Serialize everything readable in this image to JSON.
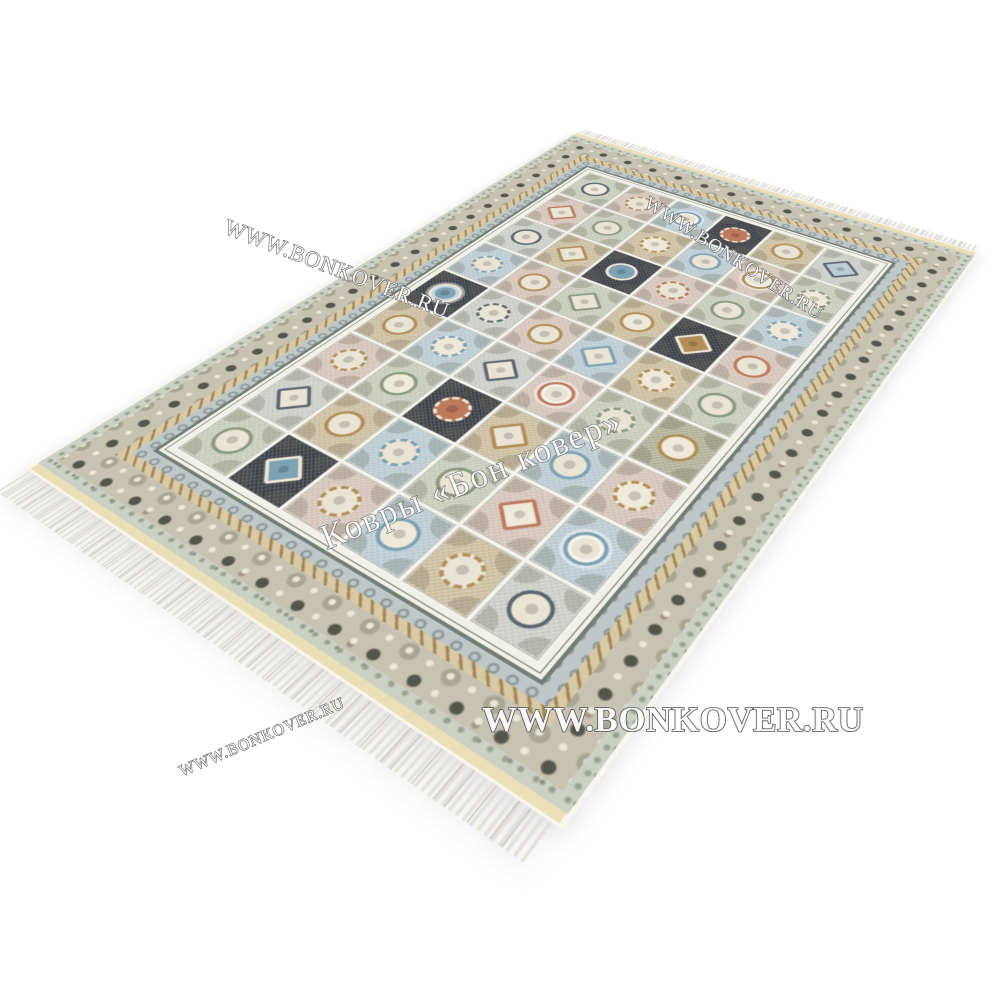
{
  "image": {
    "type": "product-photo",
    "subject": "perspective view of a classic panel-design carpet with fringe on a white background"
  },
  "watermarks": {
    "fill": "rgba(255,255,255,0.92)",
    "stroke": "#565656",
    "top_left": {
      "text": "WWW.BONKOVER.RU"
    },
    "top_right": {
      "text": "WWW.BONKOVER.RU"
    },
    "center": {
      "text": "Ковры «Бон ковер»"
    },
    "bottom_center": {
      "text": "WWW.BONKOVER.RU"
    },
    "bottom_left": {
      "text": "WWW.BONKOVER.RU"
    }
  },
  "rug": {
    "colors": {
      "selvage": "#f8f6ef",
      "kilim": "#eadfb6",
      "fringe": "#e3e1d8",
      "guard_outer_bg": "#ccd1c5",
      "guard_outer_dot": "#99a293",
      "border_main_bg": "#c7c2b1",
      "border_main_dark": "#53564b",
      "border_main_mid": "#a9a693",
      "border_main_light": "#ece9da",
      "guard_beige_bg": "#d8c9a7",
      "guard_beige_accent": "#a08453",
      "band_blue_bg": "#c0c8c7",
      "band_blue_accent": "#8b9697",
      "frame_dark": "#747e77",
      "frame_thin": "#8a9384",
      "frame_light": "#f2f1e9",
      "field_bg": "#f4f3ec"
    },
    "palette": {
      "iv": "#e9e4d4",
      "pb": "#d7c6ba",
      "bl": "#bccdd4",
      "sg": "#c9cdbb",
      "tn": "#cebfa0",
      "gy": "#cdcfc9",
      "ol": "#b3b298",
      "dk": "#3a3d42",
      "gold": "#b28e58",
      "blue2": "#7ea2b4",
      "rust": "#bd7a5d",
      "green": "#8a997f",
      "slate": "#5c6670",
      "cream": "#efe9d9"
    },
    "field": {
      "columns": 6,
      "rows": 9,
      "tiles": [
        [
          [
            "sg",
            "c",
            "slate",
            "cream"
          ],
          [
            "pb",
            "f",
            "gold",
            "iv"
          ],
          [
            "bl",
            "r",
            "blue2",
            "iv"
          ],
          [
            "dk",
            "f",
            "cream",
            "rust"
          ],
          [
            "tn",
            "c",
            "gold",
            "iv"
          ],
          [
            "gy",
            "d",
            "slate",
            "bl"
          ]
        ],
        [
          [
            "pb",
            "d",
            "rust",
            "iv"
          ],
          [
            "sg",
            "c",
            "green",
            "iv"
          ],
          [
            "tn",
            "f",
            "gold",
            "cream"
          ],
          [
            "bl",
            "c",
            "blue2",
            "iv"
          ],
          [
            "pb",
            "r",
            "gold",
            "iv"
          ],
          [
            "sg",
            "f",
            "green",
            "cream"
          ]
        ],
        [
          [
            "gy",
            "c",
            "slate",
            "iv"
          ],
          [
            "tn",
            "d",
            "gold",
            "iv"
          ],
          [
            "dk",
            "c",
            "cream",
            "blue2"
          ],
          [
            "pb",
            "f",
            "rust",
            "iv"
          ],
          [
            "sg",
            "c",
            "green",
            "iv"
          ],
          [
            "bl",
            "f",
            "blue2",
            "cream"
          ]
        ],
        [
          [
            "bl",
            "f",
            "blue2",
            "iv"
          ],
          [
            "pb",
            "c",
            "gold",
            "iv"
          ],
          [
            "sg",
            "d",
            "green",
            "iv"
          ],
          [
            "tn",
            "c",
            "gold",
            "cream"
          ],
          [
            "dk",
            "d",
            "cream",
            "gold"
          ],
          [
            "pb",
            "c",
            "rust",
            "iv"
          ]
        ],
        [
          [
            "dk",
            "r",
            "cream",
            "blue2"
          ],
          [
            "gy",
            "f",
            "slate",
            "iv"
          ],
          [
            "pb",
            "c",
            "gold",
            "iv"
          ],
          [
            "bl",
            "d",
            "blue2",
            "iv"
          ],
          [
            "tn",
            "f",
            "gold",
            "cream"
          ],
          [
            "sg",
            "c",
            "green",
            "iv"
          ]
        ],
        [
          [
            "tn",
            "c",
            "gold",
            "iv"
          ],
          [
            "bl",
            "f",
            "blue2",
            "cream"
          ],
          [
            "gy",
            "d",
            "slate",
            "iv"
          ],
          [
            "pb",
            "r",
            "rust",
            "iv"
          ],
          [
            "sg",
            "f",
            "green",
            "iv"
          ],
          [
            "ol",
            "c",
            "gold",
            "cream"
          ]
        ],
        [
          [
            "pb",
            "f",
            "gold",
            "iv"
          ],
          [
            "sg",
            "c",
            "green",
            "cream"
          ],
          [
            "dk",
            "f",
            "cream",
            "rust"
          ],
          [
            "tn",
            "d",
            "gold",
            "iv"
          ],
          [
            "bl",
            "c",
            "blue2",
            "iv"
          ],
          [
            "pb",
            "f",
            "gold",
            "cream"
          ]
        ],
        [
          [
            "gy",
            "d",
            "slate",
            "iv"
          ],
          [
            "tn",
            "c",
            "gold",
            "iv"
          ],
          [
            "bl",
            "f",
            "blue2",
            "iv"
          ],
          [
            "sg",
            "c",
            "green",
            "iv"
          ],
          [
            "pb",
            "d",
            "rust",
            "cream"
          ],
          [
            "bl",
            "r",
            "blue2",
            "iv"
          ]
        ],
        [
          [
            "sg",
            "c",
            "green",
            "iv"
          ],
          [
            "dk",
            "d",
            "cream",
            "blue2"
          ],
          [
            "pb",
            "f",
            "gold",
            "iv"
          ],
          [
            "bl",
            "c",
            "blue2",
            "cream"
          ],
          [
            "tn",
            "f",
            "gold",
            "iv"
          ],
          [
            "gy",
            "c",
            "slate",
            "iv"
          ]
        ]
      ]
    }
  }
}
